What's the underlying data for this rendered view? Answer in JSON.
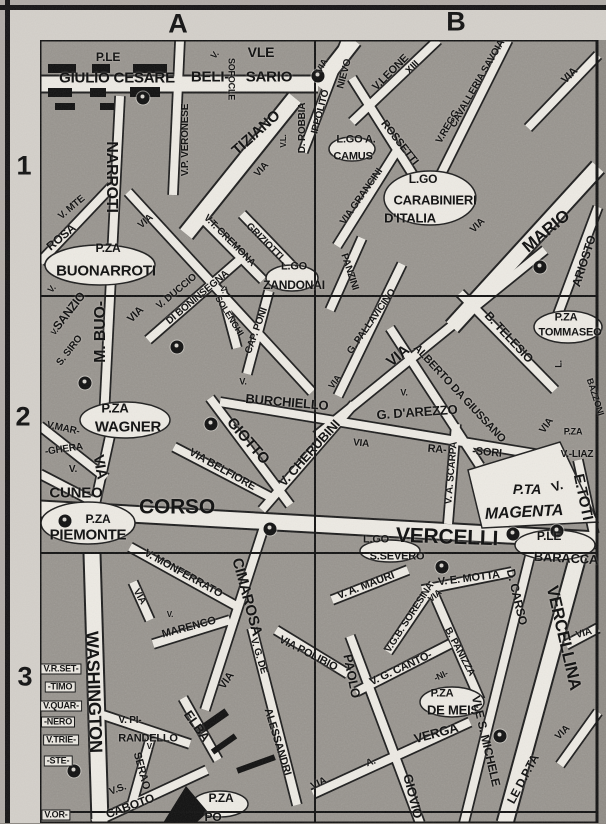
{
  "map": {
    "grid": {
      "col_labels": [
        "A",
        "B"
      ],
      "row_labels": [
        "1",
        "2",
        "3"
      ]
    },
    "colors": {
      "block_gray": "#95918b",
      "street_white": "#edeae3",
      "ink_black": "#0d0d0d",
      "margin_gray": "#d4d0ca"
    },
    "markers": [
      {
        "x": 318,
        "y": 76
      },
      {
        "x": 143,
        "y": 98
      },
      {
        "x": 85,
        "y": 383
      },
      {
        "x": 177,
        "y": 347
      },
      {
        "x": 211,
        "y": 424
      },
      {
        "x": 540,
        "y": 267
      },
      {
        "x": 65,
        "y": 521
      },
      {
        "x": 270,
        "y": 529
      },
      {
        "x": 513,
        "y": 534
      },
      {
        "x": 557,
        "y": 531
      },
      {
        "x": 442,
        "y": 567
      },
      {
        "x": 74,
        "y": 771
      },
      {
        "x": 500,
        "y": 736
      }
    ],
    "labels": [
      {
        "t": "P.LE",
        "x": 108,
        "y": 57,
        "r": 0,
        "s": 12
      },
      {
        "t": "GIULIO CESARE",
        "x": 117,
        "y": 78,
        "r": 0,
        "s": 15
      },
      {
        "t": "VLE",
        "x": 261,
        "y": 52,
        "r": 0,
        "s": 14
      },
      {
        "t": "BELI-",
        "x": 210,
        "y": 77,
        "r": 0,
        "s": 15
      },
      {
        "t": "SARIO",
        "x": 269,
        "y": 77,
        "r": 0,
        "s": 15
      },
      {
        "t": "V.",
        "x": 215,
        "y": 55,
        "r": -50,
        "s": 9
      },
      {
        "t": "SOFOCLE",
        "x": 231,
        "y": 79,
        "r": 90,
        "s": 9
      },
      {
        "t": "V.P. VERONESE",
        "x": 186,
        "y": 140,
        "r": -90,
        "s": 10
      },
      {
        "t": "TIZIANO",
        "x": 256,
        "y": 133,
        "r": -42,
        "s": 15
      },
      {
        "t": "D. ROBBIA",
        "x": 303,
        "y": 128,
        "r": -90,
        "s": 10
      },
      {
        "t": "V.L.",
        "x": 284,
        "y": 141,
        "r": -90,
        "s": 8
      },
      {
        "t": "VIA",
        "x": 262,
        "y": 170,
        "r": -48,
        "s": 10
      },
      {
        "t": "VIA",
        "x": 322,
        "y": 66,
        "r": -60,
        "s": 9
      },
      {
        "t": "IPPOLITO",
        "x": 321,
        "y": 112,
        "r": -75,
        "s": 10
      },
      {
        "t": "NIEVO",
        "x": 345,
        "y": 74,
        "r": -75,
        "s": 10
      },
      {
        "t": "V.LEONE",
        "x": 391,
        "y": 73,
        "r": -45,
        "s": 11
      },
      {
        "t": "XIII",
        "x": 413,
        "y": 68,
        "r": -45,
        "s": 10
      },
      {
        "t": "ROSSETTI",
        "x": 399,
        "y": 143,
        "r": 52,
        "s": 11
      },
      {
        "t": "V.REGG.",
        "x": 449,
        "y": 126,
        "r": -60,
        "s": 10
      },
      {
        "t": "CAVALLERIA SAVOIA",
        "x": 478,
        "y": 84,
        "r": -60,
        "s": 10
      },
      {
        "t": "VIA",
        "x": 570,
        "y": 76,
        "r": -45,
        "s": 11
      },
      {
        "t": "NARROTI",
        "x": 111,
        "y": 177,
        "r": 90,
        "s": 16
      },
      {
        "t": "M. BUO-",
        "x": 101,
        "y": 332,
        "r": -90,
        "s": 16
      },
      {
        "t": "V. MTE",
        "x": 72,
        "y": 208,
        "r": -40,
        "s": 10
      },
      {
        "t": "ROSA",
        "x": 61,
        "y": 237,
        "r": -40,
        "s": 12
      },
      {
        "t": "VIA",
        "x": 146,
        "y": 222,
        "r": -40,
        "s": 10
      },
      {
        "t": "P.ZA",
        "x": 108,
        "y": 248,
        "r": 0,
        "s": 12
      },
      {
        "t": "BUONARROTI",
        "x": 106,
        "y": 271,
        "r": 0,
        "s": 15
      },
      {
        "t": "L.GO A.",
        "x": 356,
        "y": 140,
        "r": 0,
        "s": 11
      },
      {
        "t": "CAMUS",
        "x": 353,
        "y": 157,
        "r": 0,
        "s": 11
      },
      {
        "t": "VIA GRANCINI",
        "x": 362,
        "y": 197,
        "r": -55,
        "s": 10
      },
      {
        "t": "L.GO",
        "x": 423,
        "y": 179,
        "r": 0,
        "s": 12
      },
      {
        "t": "CARABINIERI",
        "x": 435,
        "y": 200,
        "r": 0,
        "s": 13
      },
      {
        "t": "D'ITALIA",
        "x": 410,
        "y": 218,
        "r": 0,
        "s": 13
      },
      {
        "t": "VIA",
        "x": 478,
        "y": 226,
        "r": -45,
        "s": 10
      },
      {
        "t": "MARIO",
        "x": 546,
        "y": 231,
        "r": -40,
        "s": 17
      },
      {
        "t": "ARIOSTO",
        "x": 584,
        "y": 261,
        "r": -72,
        "s": 12
      },
      {
        "t": "PANZINI",
        "x": 349,
        "y": 272,
        "r": 72,
        "s": 10
      },
      {
        "t": "L.GO",
        "x": 294,
        "y": 267,
        "r": 0,
        "s": 11
      },
      {
        "t": "ZANDONAI",
        "x": 294,
        "y": 285,
        "r": 0,
        "s": 12
      },
      {
        "t": "V.",
        "x": 52,
        "y": 289,
        "r": -50,
        "s": 9
      },
      {
        "t": "SANZIO",
        "x": 69,
        "y": 311,
        "r": -52,
        "s": 12
      },
      {
        "t": "V.",
        "x": 55,
        "y": 332,
        "r": -50,
        "s": 8
      },
      {
        "t": "S. SIRO",
        "x": 70,
        "y": 351,
        "r": -52,
        "s": 10
      },
      {
        "t": "VIA",
        "x": 136,
        "y": 315,
        "r": -45,
        "s": 11
      },
      {
        "t": "V. DUCCIO",
        "x": 177,
        "y": 292,
        "r": -40,
        "s": 10
      },
      {
        "t": "DI BONINSEGNA",
        "x": 198,
        "y": 298,
        "r": -40,
        "s": 10
      },
      {
        "t": "V.T. CREMONA",
        "x": 229,
        "y": 241,
        "r": 45,
        "s": 10
      },
      {
        "t": "GRIZIOTTI",
        "x": 264,
        "y": 242,
        "r": 45,
        "s": 10
      },
      {
        "t": "V.",
        "x": 223,
        "y": 290,
        "r": 58,
        "s": 8
      },
      {
        "t": "SOLENGHI",
        "x": 229,
        "y": 316,
        "r": 58,
        "s": 9
      },
      {
        "t": "CAP. PONI",
        "x": 257,
        "y": 331,
        "r": -70,
        "s": 10
      },
      {
        "t": "VIA",
        "x": 335,
        "y": 382,
        "r": -55,
        "s": 9
      },
      {
        "t": "G. PALLAVICINO",
        "x": 372,
        "y": 322,
        "r": -55,
        "s": 10
      },
      {
        "t": "VIA",
        "x": 398,
        "y": 356,
        "r": -40,
        "s": 15
      },
      {
        "t": "ALBERTO DA GIUSSANO",
        "x": 459,
        "y": 394,
        "r": 47,
        "s": 11
      },
      {
        "t": "B. TELESIO",
        "x": 509,
        "y": 337,
        "r": 47,
        "s": 12
      },
      {
        "t": "P.ZA",
        "x": 566,
        "y": 318,
        "r": 0,
        "s": 11
      },
      {
        "t": "TOMMASEO",
        "x": 570,
        "y": 333,
        "r": 0,
        "s": 11
      },
      {
        "t": "L.",
        "x": 559,
        "y": 364,
        "r": -90,
        "s": 9
      },
      {
        "t": "P.ZA",
        "x": 115,
        "y": 408,
        "r": 0,
        "s": 13
      },
      {
        "t": "WAGNER",
        "x": 128,
        "y": 427,
        "r": 0,
        "s": 15
      },
      {
        "t": "V.MAR-",
        "x": 63,
        "y": 429,
        "r": 12,
        "s": 10
      },
      {
        "t": "-GHERA",
        "x": 64,
        "y": 450,
        "r": -8,
        "s": 10
      },
      {
        "t": "VIA",
        "x": 100,
        "y": 467,
        "r": 80,
        "s": 15
      },
      {
        "t": "V.",
        "x": 73,
        "y": 470,
        "r": 0,
        "s": 10
      },
      {
        "t": "CUNEO",
        "x": 76,
        "y": 493,
        "r": 0,
        "s": 15
      },
      {
        "t": "P.ZA",
        "x": 98,
        "y": 519,
        "r": 0,
        "s": 12
      },
      {
        "t": "PIEMONTE",
        "x": 88,
        "y": 535,
        "r": 0,
        "s": 15
      },
      {
        "t": "V.",
        "x": 243,
        "y": 382,
        "r": 0,
        "s": 9
      },
      {
        "t": "BURCHIELLO",
        "x": 287,
        "y": 402,
        "r": 5,
        "s": 13
      },
      {
        "t": "GIOTTO",
        "x": 248,
        "y": 441,
        "r": 49,
        "s": 15
      },
      {
        "t": "V. CHERUBINI",
        "x": 309,
        "y": 453,
        "r": -48,
        "s": 13
      },
      {
        "t": "VIA BELFIORE",
        "x": 222,
        "y": 470,
        "r": 29,
        "s": 11
      },
      {
        "t": "VIA",
        "x": 361,
        "y": 444,
        "r": 5,
        "s": 10
      },
      {
        "t": "RA-",
        "x": 437,
        "y": 450,
        "r": 5,
        "s": 11
      },
      {
        "t": "-SORI",
        "x": 487,
        "y": 453,
        "r": 5,
        "s": 11
      },
      {
        "t": "V. A. SCARPA",
        "x": 452,
        "y": 473,
        "r": -85,
        "s": 10
      },
      {
        "t": "V.",
        "x": 404,
        "y": 393,
        "r": 0,
        "s": 9
      },
      {
        "t": "G. D'AREZZO",
        "x": 417,
        "y": 412,
        "r": -4,
        "s": 13
      },
      {
        "t": "VIA",
        "x": 547,
        "y": 426,
        "r": -55,
        "s": 10
      },
      {
        "t": "P.ZA",
        "x": 573,
        "y": 432,
        "r": 0,
        "s": 9
      },
      {
        "t": "V.-LIAZ",
        "x": 577,
        "y": 455,
        "r": 0,
        "s": 10
      },
      {
        "t": "BAZZONI",
        "x": 595,
        "y": 397,
        "r": 72,
        "s": 9
      },
      {
        "t": "V.",
        "x": 557,
        "y": 486,
        "r": -20,
        "s": 13
      },
      {
        "t": "E.TOTI",
        "x": 583,
        "y": 497,
        "r": 78,
        "s": 15
      },
      {
        "t": "P.TA",
        "x": 527,
        "y": 489,
        "r": 0,
        "s": 14,
        "it": 1
      },
      {
        "t": "MAGENTA",
        "x": 524,
        "y": 513,
        "r": -3,
        "s": 16,
        "it": 1
      },
      {
        "t": "CORSO",
        "x": 177,
        "y": 507,
        "r": 0,
        "s": 21
      },
      {
        "t": "VERCELLI",
        "x": 447,
        "y": 537,
        "r": 2,
        "s": 21
      },
      {
        "t": "L.GO",
        "x": 376,
        "y": 540,
        "r": 0,
        "s": 11
      },
      {
        "t": "S.SEVERO",
        "x": 397,
        "y": 557,
        "r": 0,
        "s": 11
      },
      {
        "t": "P.LE",
        "x": 549,
        "y": 536,
        "r": 0,
        "s": 12
      },
      {
        "t": "BARACCA",
        "x": 566,
        "y": 558,
        "r": 3,
        "s": 13
      },
      {
        "t": "V. MONFERRATO",
        "x": 183,
        "y": 574,
        "r": 29,
        "s": 11
      },
      {
        "t": "VIA",
        "x": 139,
        "y": 597,
        "r": 60,
        "s": 10
      },
      {
        "t": "V.",
        "x": 170,
        "y": 615,
        "r": 0,
        "s": 8
      },
      {
        "t": "MARENCO",
        "x": 189,
        "y": 628,
        "r": -15,
        "s": 11
      },
      {
        "t": "CIMAROSA",
        "x": 247,
        "y": 597,
        "r": 75,
        "s": 15
      },
      {
        "t": "VIA",
        "x": 227,
        "y": 681,
        "r": -55,
        "s": 11
      },
      {
        "t": "V. G. DE",
        "x": 258,
        "y": 656,
        "r": 73,
        "s": 10
      },
      {
        "t": "ALESSANDRI",
        "x": 277,
        "y": 742,
        "r": 73,
        "s": 11
      },
      {
        "t": "VIA POLIBIO",
        "x": 308,
        "y": 654,
        "r": 27,
        "s": 11
      },
      {
        "t": "PAOLO",
        "x": 352,
        "y": 676,
        "r": 79,
        "s": 13
      },
      {
        "t": "GIOVIO",
        "x": 413,
        "y": 796,
        "r": 76,
        "s": 13
      },
      {
        "t": "V. A. MAURI",
        "x": 366,
        "y": 586,
        "r": -21,
        "s": 11
      },
      {
        "t": "V. E. MOTTA",
        "x": 469,
        "y": 579,
        "r": -7,
        "s": 11
      },
      {
        "t": "V.G.B. SORESINA",
        "x": 410,
        "y": 618,
        "r": -57,
        "s": 10
      },
      {
        "t": "VIA",
        "x": 435,
        "y": 596,
        "r": -40,
        "s": 9
      },
      {
        "t": "B. PANIZZA",
        "x": 459,
        "y": 652,
        "r": 62,
        "s": 10
      },
      {
        "t": "V. G. CANTO-",
        "x": 401,
        "y": 669,
        "r": -25,
        "s": 11
      },
      {
        "t": "-NI-",
        "x": 441,
        "y": 676,
        "r": -25,
        "s": 9
      },
      {
        "t": "P.ZA",
        "x": 442,
        "y": 694,
        "r": 0,
        "s": 11
      },
      {
        "t": "DE MEIS",
        "x": 453,
        "y": 710,
        "r": 0,
        "s": 13
      },
      {
        "t": "VIA",
        "x": 319,
        "y": 784,
        "r": -25,
        "s": 10
      },
      {
        "t": "A.",
        "x": 371,
        "y": 763,
        "r": -20,
        "s": 10
      },
      {
        "t": "VERGA",
        "x": 436,
        "y": 733,
        "r": -15,
        "s": 13
      },
      {
        "t": "VLE S. MICHELE",
        "x": 486,
        "y": 741,
        "r": 77,
        "s": 12
      },
      {
        "t": "D. CARSO",
        "x": 517,
        "y": 597,
        "r": 77,
        "s": 12
      },
      {
        "t": "LE D.P.TA",
        "x": 523,
        "y": 779,
        "r": -62,
        "s": 12
      },
      {
        "t": "VERCELLINA",
        "x": 564,
        "y": 638,
        "r": 77,
        "s": 17
      },
      {
        "t": "VIA",
        "x": 563,
        "y": 733,
        "r": -45,
        "s": 10
      },
      {
        "t": "VIA",
        "x": 584,
        "y": 634,
        "r": -15,
        "s": 10
      },
      {
        "t": "WASHINGTON",
        "x": 94,
        "y": 692,
        "r": 88,
        "s": 18
      },
      {
        "t": "V.R.SET-",
        "x": 61,
        "y": 669,
        "r": 0,
        "s": 9,
        "box": 1
      },
      {
        "t": "-TIMO",
        "x": 60,
        "y": 687,
        "r": 0,
        "s": 9,
        "box": 1
      },
      {
        "t": "V.QUAR-",
        "x": 61,
        "y": 706,
        "r": 0,
        "s": 9,
        "box": 1
      },
      {
        "t": "-NERO",
        "x": 58,
        "y": 722,
        "r": 0,
        "s": 9,
        "box": 1
      },
      {
        "t": "V.TRIE-",
        "x": 61,
        "y": 740,
        "r": 0,
        "s": 9,
        "box": 1
      },
      {
        "t": "-STE-",
        "x": 58,
        "y": 761,
        "r": 0,
        "s": 9,
        "box": 1
      },
      {
        "t": "V.OR-",
        "x": 56,
        "y": 815,
        "r": 0,
        "s": 9,
        "box": 1
      },
      {
        "t": "V. PI-",
        "x": 130,
        "y": 721,
        "r": 0,
        "s": 10
      },
      {
        "t": "RANDELLO",
        "x": 148,
        "y": 739,
        "r": 0,
        "s": 11
      },
      {
        "t": "V.",
        "x": 150,
        "y": 747,
        "r": 0,
        "s": 8
      },
      {
        "t": "SERAO",
        "x": 141,
        "y": 771,
        "r": 75,
        "s": 11
      },
      {
        "t": "ELBA",
        "x": 197,
        "y": 726,
        "r": 55,
        "s": 13
      },
      {
        "t": "V.S.",
        "x": 118,
        "y": 790,
        "r": -20,
        "s": 10
      },
      {
        "t": "CABOTO",
        "x": 130,
        "y": 806,
        "r": -20,
        "s": 12
      },
      {
        "t": "P.ZA",
        "x": 221,
        "y": 798,
        "r": 0,
        "s": 12
      },
      {
        "t": "PO",
        "x": 213,
        "y": 817,
        "r": 0,
        "s": 12
      }
    ]
  }
}
